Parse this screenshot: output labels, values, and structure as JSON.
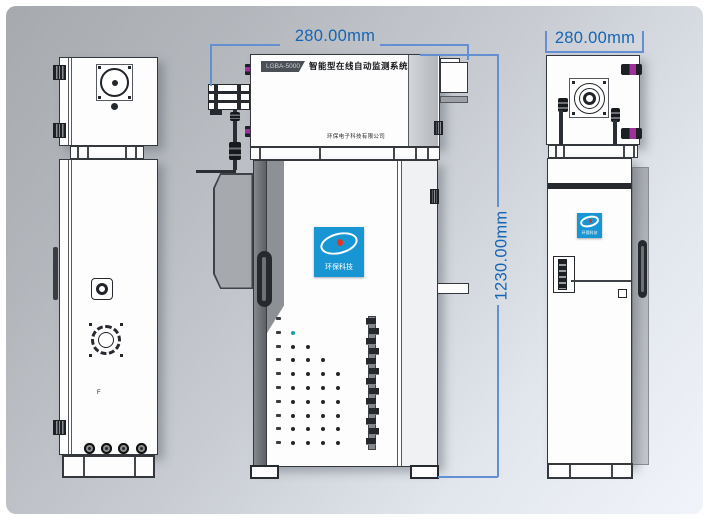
{
  "drawing": {
    "type": "engineering-dimension-diagram",
    "views": [
      "left-side-view",
      "front-view",
      "right-side-view"
    ]
  },
  "dimensions": {
    "front_width": "280.00mm",
    "side_width": "280.00mm",
    "height": "1230.00mm"
  },
  "front_view": {
    "model_badge": "LGBA-5000",
    "title": "智能型在线自动监测系统",
    "company_line": "环保电子科技有限公司",
    "logo_caption": "环保科技",
    "port_rows": [
      1,
      2,
      3,
      4,
      5,
      5,
      5,
      5,
      5,
      5
    ],
    "terminal_blocks": 13
  },
  "right_view": {
    "logo_caption": "环保科技"
  },
  "left_view": {
    "panel_label": "F"
  },
  "colors": {
    "dimension_text": "#1565b4",
    "dimension_line": "#6290d2",
    "logo_blue": "#1896d3",
    "connector_magenta": "#a0309c",
    "outline": "#34373c"
  }
}
